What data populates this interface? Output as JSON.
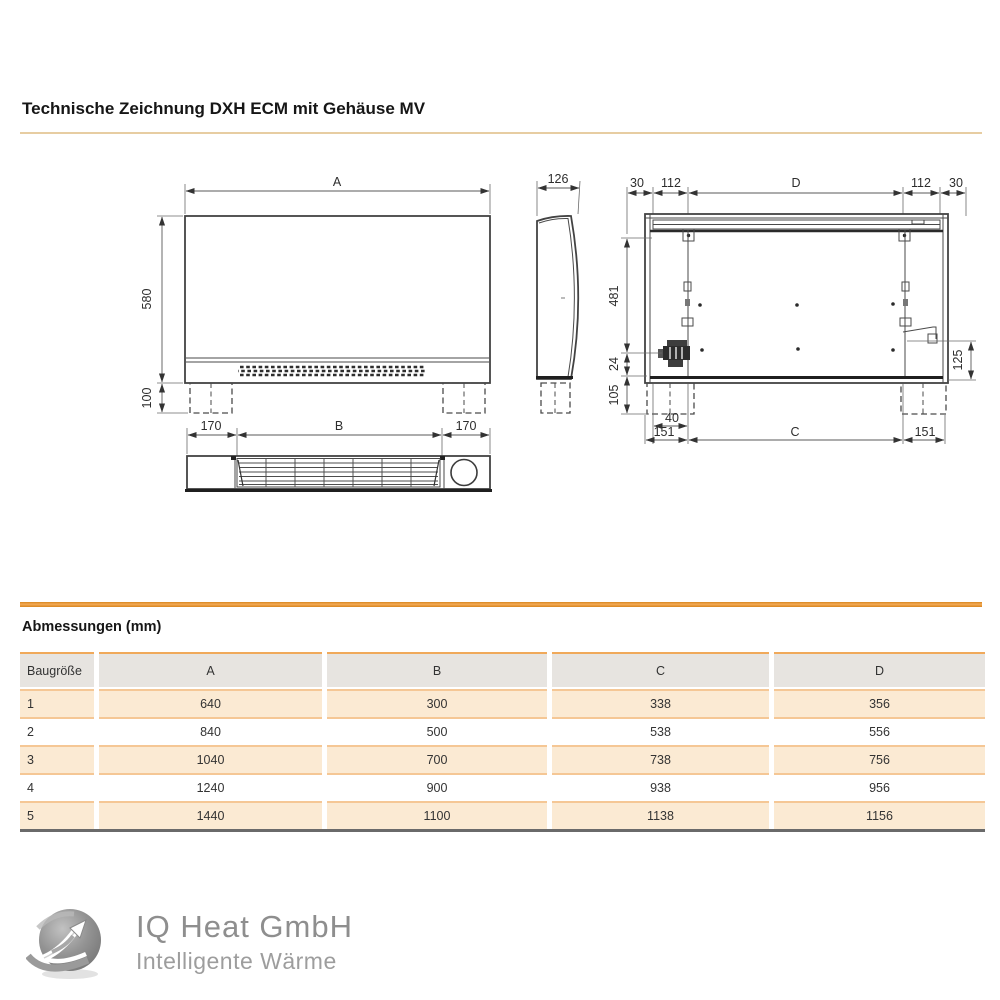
{
  "title": "Technische Zeichnung DXH ECM mit Gehäuse MV",
  "drawing": {
    "front": {
      "width_label": "A",
      "height": "580",
      "feet_height": "100",
      "bottom": [
        "170",
        "B",
        "170"
      ]
    },
    "side": {
      "depth": "126"
    },
    "rear": {
      "top": [
        "30",
        "112",
        "D",
        "112",
        "30"
      ],
      "left": [
        "481",
        "24",
        "105"
      ],
      "right_bracket": "125",
      "cable_offset": "40",
      "bottom": [
        "151",
        "C",
        "151"
      ]
    }
  },
  "table": {
    "heading": "Abmessungen (mm)",
    "columns": [
      "Baugröße",
      "A",
      "B",
      "C",
      "D"
    ],
    "rows": [
      [
        "1",
        "640",
        "300",
        "338",
        "356"
      ],
      [
        "2",
        "840",
        "500",
        "538",
        "556"
      ],
      [
        "3",
        "1040",
        "700",
        "738",
        "756"
      ],
      [
        "4",
        "1240",
        "900",
        "938",
        "956"
      ],
      [
        "5",
        "1440",
        "1100",
        "1138",
        "1156"
      ]
    ]
  },
  "footer": {
    "company": "IQ Heat GmbH",
    "tagline": "Intelligente Wärme"
  },
  "colors": {
    "accent_orange": "#e8941e",
    "row_shade": "#fbead3",
    "header_gray": "#e7e4e0",
    "rule_tan": "#e7cda2",
    "table_bottom_gray": "#6a6a6a"
  }
}
